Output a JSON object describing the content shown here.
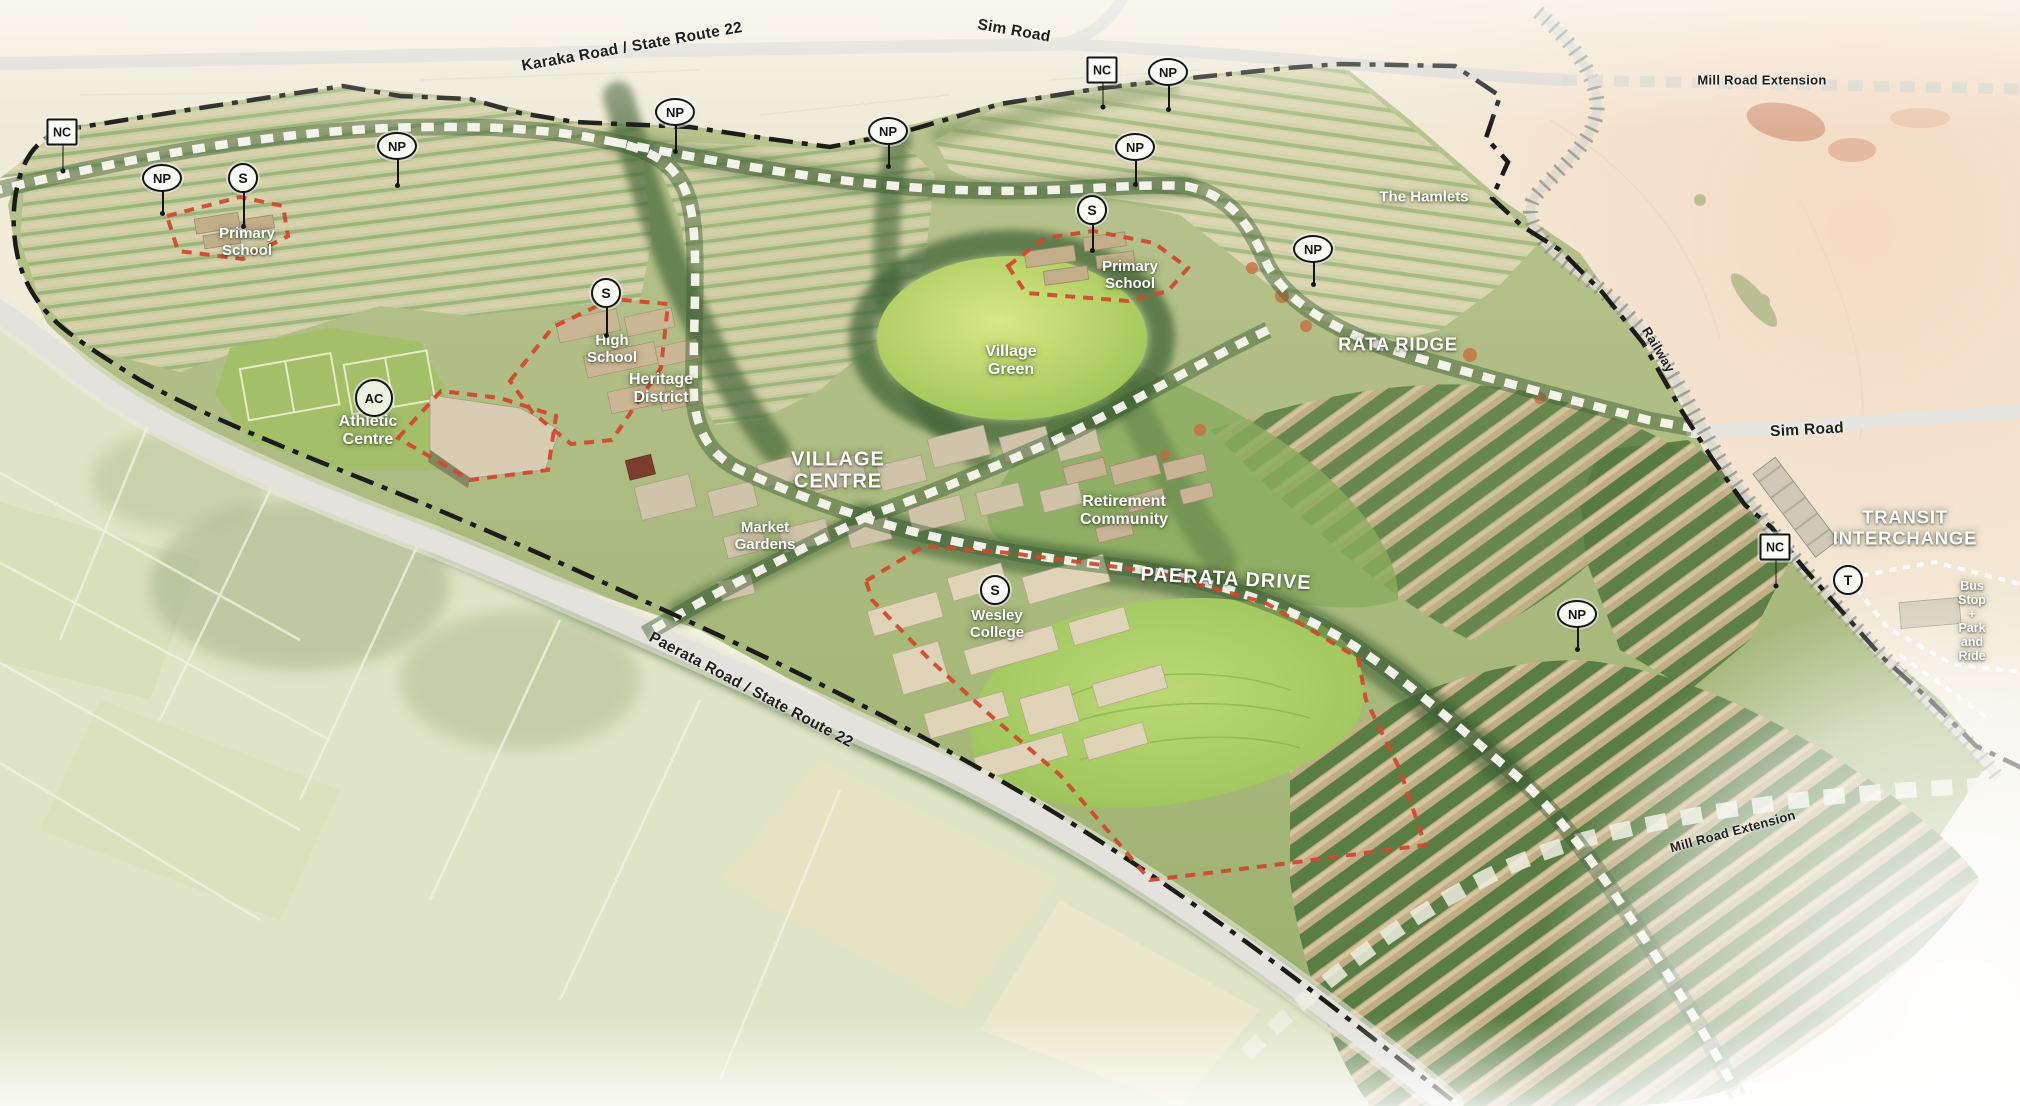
{
  "map": {
    "road_labels": [
      {
        "name": "karaka-road-label",
        "text": "Karaka Road / State Route 22",
        "x": 632,
        "y": 47,
        "rot": -10,
        "cls": ""
      },
      {
        "name": "sim-road-top-label",
        "text": "Sim Road",
        "x": 1014,
        "y": 31,
        "rot": 10,
        "cls": ""
      },
      {
        "name": "mill-road-extension-top-label",
        "text": "Mill Road Extension",
        "x": 1762,
        "y": 81,
        "rot": 0,
        "cls": "small"
      },
      {
        "name": "railway-label",
        "text": "Railway",
        "x": 1658,
        "y": 350,
        "rot": 59,
        "cls": "small"
      },
      {
        "name": "sim-road-right-label",
        "text": "Sim Road",
        "x": 1807,
        "y": 430,
        "rot": -3,
        "cls": ""
      },
      {
        "name": "paerata-road-label",
        "text": "Paerata Road / State Route 22",
        "x": 751,
        "y": 690,
        "rot": 28,
        "cls": ""
      },
      {
        "name": "mill-road-extension-bottom-label",
        "text": "Mill Road Extension",
        "x": 1733,
        "y": 832,
        "rot": -15,
        "cls": "small"
      }
    ],
    "area_labels": [
      {
        "name": "primary-school-west-label",
        "text": "Primary\nSchool",
        "x": 247,
        "y": 243,
        "rot": 0,
        "cls": ""
      },
      {
        "name": "high-school-label",
        "text": "High\nSchool",
        "x": 612,
        "y": 350,
        "rot": 0,
        "cls": ""
      },
      {
        "name": "heritage-district-label",
        "text": "Heritage\nDistrict",
        "x": 661,
        "y": 389,
        "rot": 0,
        "cls": "md"
      },
      {
        "name": "athletic-centre-label",
        "text": "Athletic\nCentre",
        "x": 368,
        "y": 431,
        "rot": 0,
        "cls": "md"
      },
      {
        "name": "primary-school-east-label",
        "text": "Primary\nSchool",
        "x": 1130,
        "y": 276,
        "rot": 0,
        "cls": ""
      },
      {
        "name": "village-green-label",
        "text": "Village\nGreen",
        "x": 1011,
        "y": 361,
        "rot": 0,
        "cls": "md"
      },
      {
        "name": "village-centre-label",
        "text": "VILLAGE\nCENTRE",
        "x": 838,
        "y": 471,
        "rot": 0,
        "cls": "xl"
      },
      {
        "name": "market-gardens-label",
        "text": "Market\nGardens",
        "x": 765,
        "y": 537,
        "rot": 0,
        "cls": ""
      },
      {
        "name": "retirement-community-label",
        "text": "Retirement\nCommunity",
        "x": 1124,
        "y": 511,
        "rot": 0,
        "cls": "md"
      },
      {
        "name": "rata-ridge-label",
        "text": "RATA RIDGE",
        "x": 1398,
        "y": 345,
        "rot": 0,
        "cls": "lg"
      },
      {
        "name": "the-hamlets-label",
        "text": "The Hamlets",
        "x": 1424,
        "y": 198,
        "rot": 0,
        "cls": ""
      },
      {
        "name": "paerata-drive-label",
        "text": "PAERATA DRIVE",
        "x": 1226,
        "y": 579,
        "rot": 3,
        "cls": "xl"
      },
      {
        "name": "wesley-college-label",
        "text": "Wesley\nCollege",
        "x": 997,
        "y": 625,
        "rot": 0,
        "cls": ""
      },
      {
        "name": "transit-interchange-label",
        "text": "TRANSIT\nINTERCHANGE",
        "x": 1905,
        "y": 528,
        "rot": 0,
        "cls": "lg"
      },
      {
        "name": "bus-stop-label",
        "text": "Bus Stop\n+\nPark and Ride",
        "x": 1972,
        "y": 621,
        "rot": 0,
        "cls": "sm"
      }
    ],
    "badges": [
      {
        "name": "badge-nc-northwest",
        "shape": "rect",
        "text": "NC",
        "x": 62,
        "y": 132,
        "leader": 26
      },
      {
        "name": "badge-np-1",
        "shape": "oval",
        "text": "NP",
        "x": 162,
        "y": 178,
        "leader": 22
      },
      {
        "name": "badge-s-primary-west",
        "shape": "circle",
        "text": "S",
        "x": 243,
        "y": 178,
        "leader": 34
      },
      {
        "name": "badge-np-2",
        "shape": "oval",
        "text": "NP",
        "x": 397,
        "y": 146,
        "leader": 26
      },
      {
        "name": "badge-np-3",
        "shape": "oval",
        "text": "NP",
        "x": 675,
        "y": 112,
        "leader": 26
      },
      {
        "name": "badge-np-4",
        "shape": "oval",
        "text": "NP",
        "x": 888,
        "y": 131,
        "leader": 22
      },
      {
        "name": "badge-nc-north",
        "shape": "rect",
        "text": "NC",
        "x": 1102,
        "y": 70,
        "leader": 24
      },
      {
        "name": "badge-np-5",
        "shape": "oval",
        "text": "NP",
        "x": 1168,
        "y": 72,
        "leader": 24
      },
      {
        "name": "badge-np-6",
        "shape": "oval",
        "text": "NP",
        "x": 1135,
        "y": 147,
        "leader": 24
      },
      {
        "name": "badge-np-rata",
        "shape": "oval",
        "text": "NP",
        "x": 1313,
        "y": 249,
        "leader": 22
      },
      {
        "name": "badge-s-high-school",
        "shape": "circle",
        "text": "S",
        "x": 606,
        "y": 293,
        "leader": 28
      },
      {
        "name": "badge-ac",
        "shape": "circle-lg",
        "text": "AC",
        "x": 374,
        "y": 398,
        "leader": 0
      },
      {
        "name": "badge-s-primary-east",
        "shape": "circle",
        "text": "S",
        "x": 1092,
        "y": 210,
        "leader": 26
      },
      {
        "name": "badge-np-south",
        "shape": "oval",
        "text": "NP",
        "x": 1577,
        "y": 614,
        "leader": 22
      },
      {
        "name": "badge-s-wesley",
        "shape": "circle",
        "text": "S",
        "x": 995,
        "y": 590,
        "leader": 0
      },
      {
        "name": "badge-nc-transit",
        "shape": "rect",
        "text": "NC",
        "x": 1775,
        "y": 547,
        "leader": 26
      },
      {
        "name": "badge-t-transit",
        "shape": "circle",
        "text": "T",
        "x": 1848,
        "y": 580,
        "leader": 0
      }
    ],
    "colors": {
      "boundary_black": "#1b1b17",
      "site_outline_red": "#d2492e",
      "street_dash_white": "#faf9f2",
      "road_grey": "#dbdad2",
      "area_label_white": "#ffffff",
      "road_label_black": "#1e1e1a",
      "village_green": "#a2c75c",
      "terrain_green": "#a9b97e",
      "warm_haze": "#f6d8c0"
    }
  }
}
